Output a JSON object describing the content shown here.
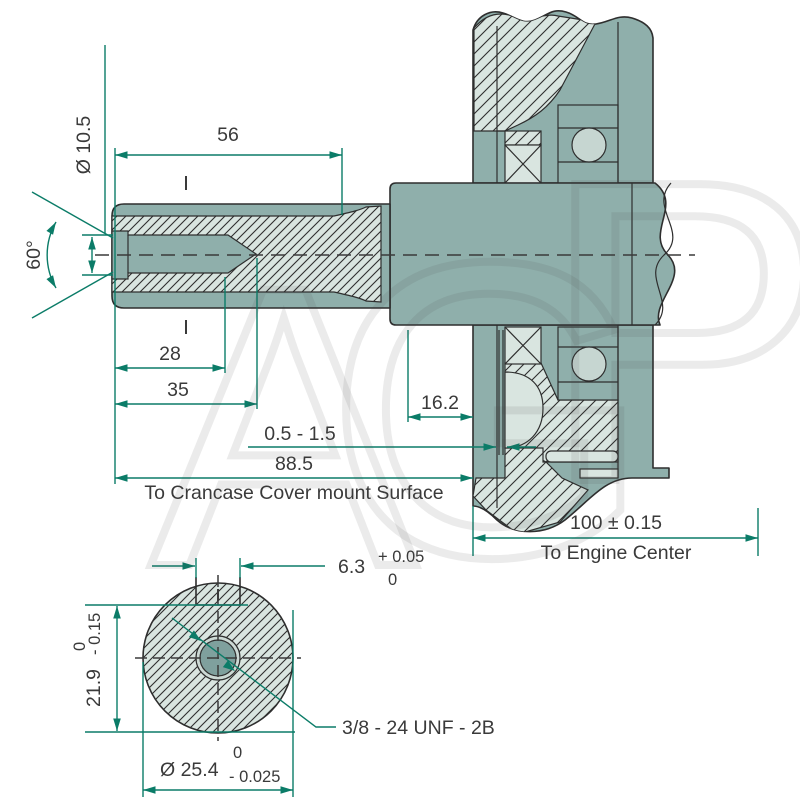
{
  "colors": {
    "background": "#FFFFFF",
    "body": "#8FAFAB",
    "hatch": "#D9E5E0",
    "ball": "#C6D6D1",
    "ring": "#CCD9D4",
    "hole": "#7FA09D",
    "outline": "#2E2E2E",
    "dim": "#0B7C68",
    "text": "#3A3A3A",
    "watermark": "rgba(70,70,70,0.11)"
  },
  "watermark_letters": [
    "A",
    "G",
    "P"
  ],
  "side_view": {
    "dia_10_5": "Ø 10.5",
    "len_56": "56",
    "angle_60": "60°",
    "len_28": "28",
    "len_35": "35",
    "len_16_2": "16.2",
    "clearance": "0.5 - 1.5",
    "len_88_5": "88.5",
    "crankcase_note": "To Crancase Cover mount Surface",
    "len_100": "100 ± 0.15",
    "engine_center_note": "To Engine Center"
  },
  "end_view": {
    "keyway_width": "6.3",
    "keyway_tol_upper": "+ 0.05",
    "keyway_tol_lower": "0",
    "key_height": "21.9",
    "key_height_tol_upper": "0",
    "key_height_tol_lower": "- 0.15",
    "dia": "Ø 25.4",
    "dia_tol_upper": "0",
    "dia_tol_lower": "- 0.025",
    "thread": "3/8 - 24 UNF - 2B"
  }
}
